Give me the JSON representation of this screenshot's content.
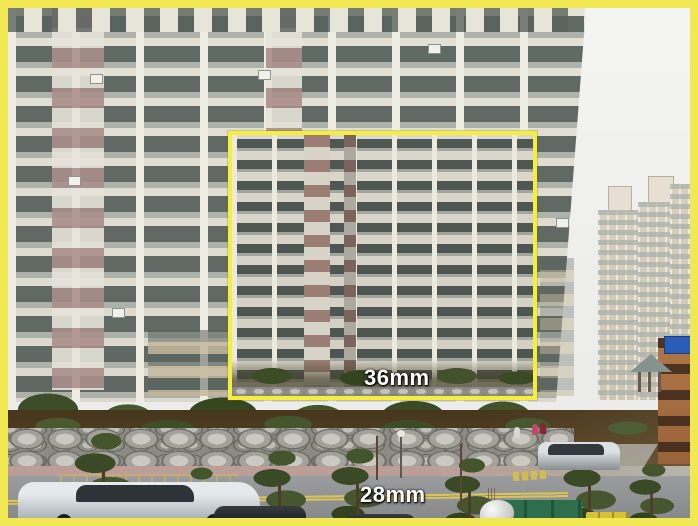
{
  "meta": {
    "title": "Focal length field-of-view comparison photo",
    "type": "photograph-with-overlay"
  },
  "labels": {
    "full_frame_focal_length": "28mm",
    "inset_focal_length": "36mm"
  },
  "colors": {
    "frame_border_yellow": "#f1e854",
    "inset_border_yellow": "#f6ee3c",
    "label_text": "#ffffff",
    "sky": "#f2f2f0",
    "building_wall_cream": "#e2dfd4",
    "building_accent_mauve": "#aa8e8b",
    "window_glass": "#5c6863",
    "distant_building_tan": "#d7cebc",
    "road_gray": "#8f9193",
    "lane_marking_yellow": "#d9c454",
    "foliage_green": "#3e4e2a",
    "rock_gray": "#b9b9b1"
  },
  "scene": {
    "subject": "high-rise apartment complex with street, rock retaining wall, pine trees, cars, bins and pedestrians",
    "overlay": "yellow rectangle marking the 36mm field of view inside the 28mm photograph"
  }
}
